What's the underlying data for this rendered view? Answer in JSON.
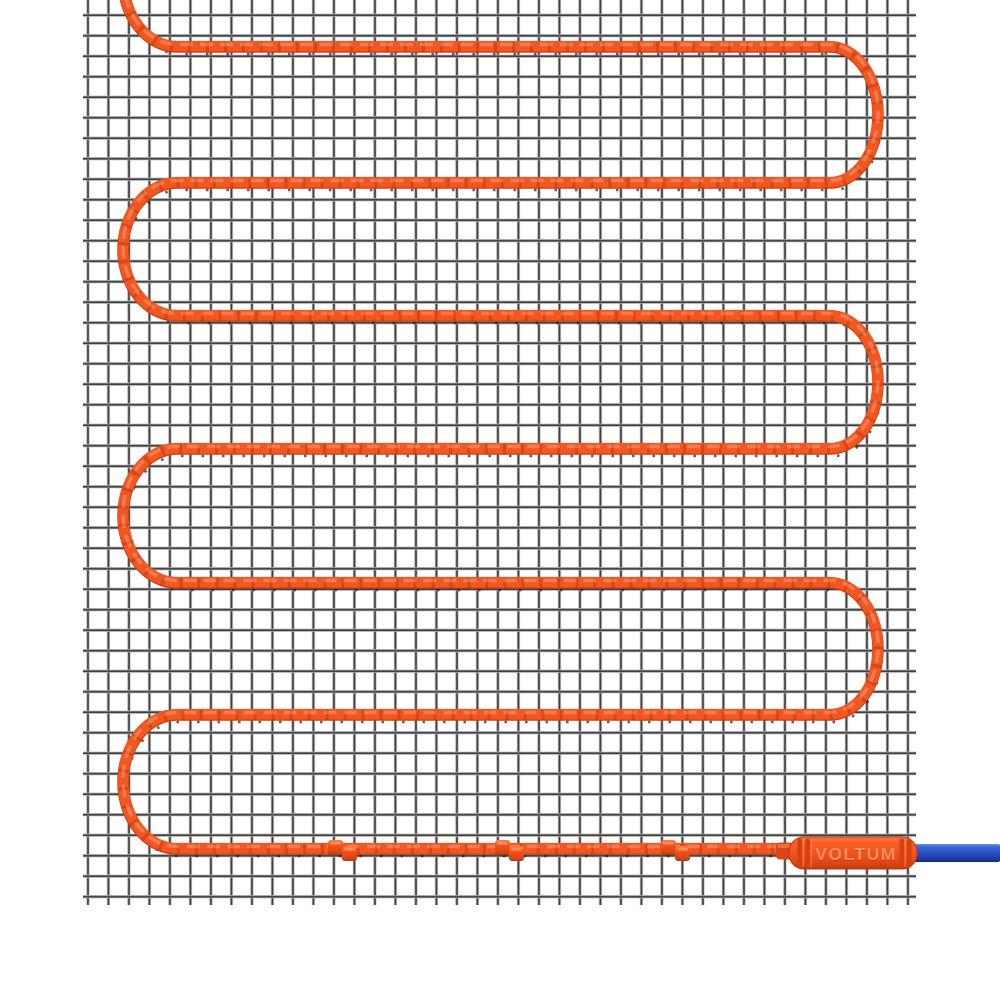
{
  "connector": {
    "label": "VOLTUM"
  },
  "colors": {
    "background": "#ffffff",
    "heating_cable": "#f2571f",
    "heating_cable_dark": "#c93d13",
    "heating_cable_light": "#ff8049",
    "twist_mark": "#ba300e",
    "connector_body": "#f2531d",
    "connector_label_fill": "#ff8e5f",
    "cold_lead_blue": "#2a53c8",
    "mesh_wire_dark": "#3f3f3f",
    "mesh_wire_light": "#b7b7b7"
  },
  "structure": {
    "cable_runs": 7,
    "clip_count": 3
  }
}
